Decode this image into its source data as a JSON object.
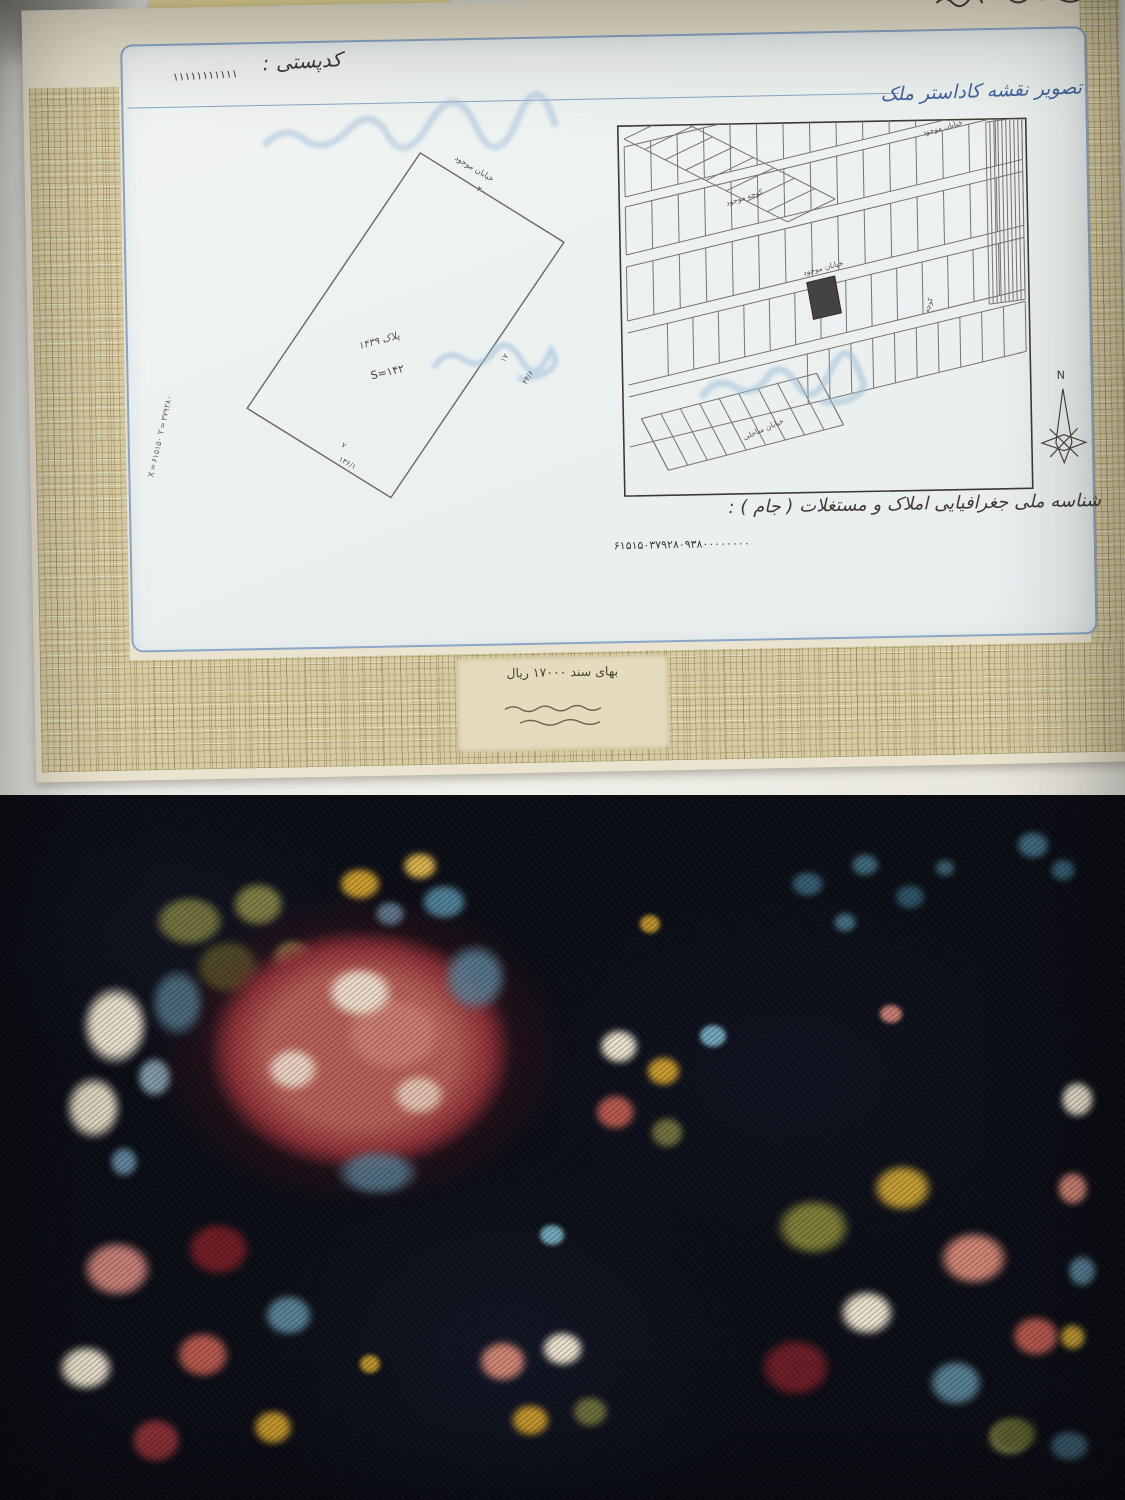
{
  "document": {
    "postal_code_label": "کدپستی :",
    "postal_code_digits": "۱۱۱۱۱۱۱۱۱۱۱",
    "map_section_title": "تصویر نقشه کاداستر ملک",
    "national_id_label": "شناسه ملی جغرافیایی املاک و مستغلات ( جام ) :",
    "national_id_value": "۶۱۵۱۵۰۳۷۹۲۸۰۹۳۸۰۰۰۰۰۰۰۰",
    "stamp_price_line": "بهای سند ۱۷۰۰۰ ریال",
    "left_map": {
      "parcel_label": "پلاک ۱۴۳۹",
      "area_value": "S=۱۴۲",
      "street_label": "خیابان موجود",
      "street_width": "۲۰",
      "dim_right_upper": "۱۷",
      "dim_right_lower": "۴۴/۶",
      "dim_bottom_upper": "۷",
      "dim_bottom_lower": "۱۳۶/۱",
      "side_coordinates": "X=۶۱۵۱۵۰  Y=۳۷۹۲۸۰"
    },
    "right_map": {
      "street_top": "خیابان موجود",
      "street_mid": "کوچه موجود",
      "street_bottom": "خیابان ساحلی",
      "alley": "کوچه",
      "north_label": "N"
    }
  },
  "colors": {
    "paper_cream": "#eae3cf",
    "weave_tan": "#d6cba2",
    "panel_blue_white": "#eef2f0",
    "ink_blue": "#44659f",
    "border_blue": "#8aa6c8",
    "carpet_navy": "#0b0d15",
    "rose_pink": "#c97b6e",
    "deep_maroon": "#7a2430",
    "cream_flower": "#e7decb",
    "steel_blue": "#5d8298",
    "olive_green": "#6f6f3d",
    "mustard_gold": "#c79a2d"
  }
}
